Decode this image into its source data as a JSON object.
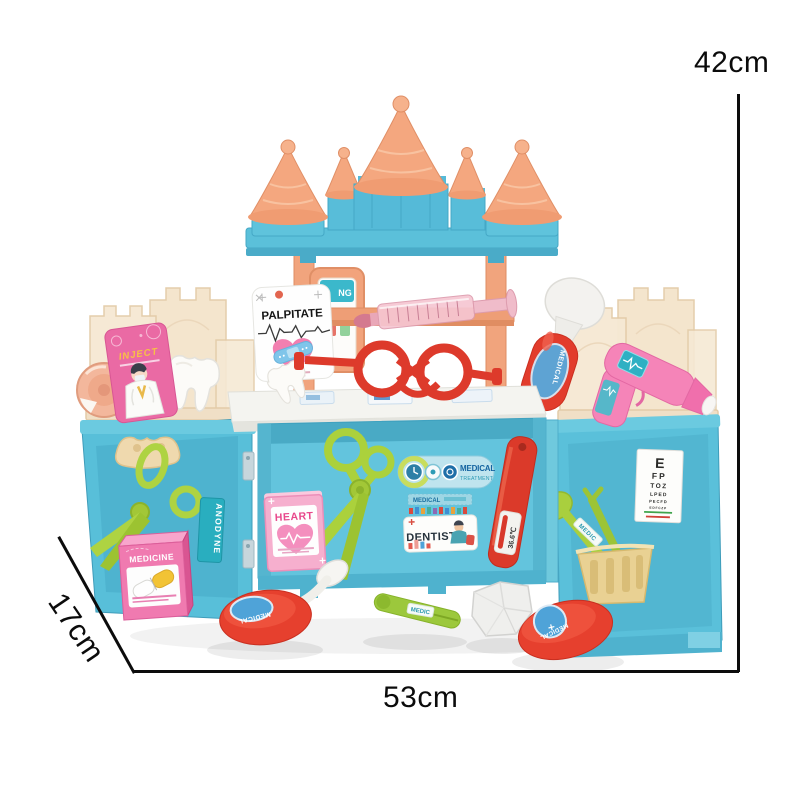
{
  "dimensions": {
    "height": "42cm",
    "width": "53cm",
    "depth": "17cm"
  },
  "toy": {
    "palpitate": "PALPITATE",
    "frame_card": "NG",
    "inject": "INJECT",
    "heart": "HEART",
    "anodyne": "ANODYNE",
    "medicine": "MEDICINE",
    "medical_treatment": {
      "line1": "MEDICAL",
      "line2": "TREATMENT"
    },
    "medical_strip": "MEDICAL",
    "dentist": "DENTIST",
    "thermometer_reading": "36.6℃",
    "otoscope_label": "MEDICAL",
    "mirror_label": "MEDICAL",
    "magnifier_label": "MEDICAL",
    "tweezers_label": "MEDIC",
    "spoon_label": "MEDIC",
    "eye_chart": {
      "rows": [
        "E",
        "FP",
        "TOZ",
        "LPED",
        "PECFD",
        "EDFCZP"
      ]
    }
  },
  "colors": {
    "castle_blue": "#5EC1DB",
    "cone_salmon": "#F4A77F",
    "panel_beige": "#F6E9D4",
    "tool_red": "#E0392D",
    "tool_green": "#A9CF3A",
    "pink": "#F07AB0",
    "basket_yellow": "#EAD295",
    "label_teal": "#29AEBF",
    "counter_white": "#F4F4F0"
  }
}
